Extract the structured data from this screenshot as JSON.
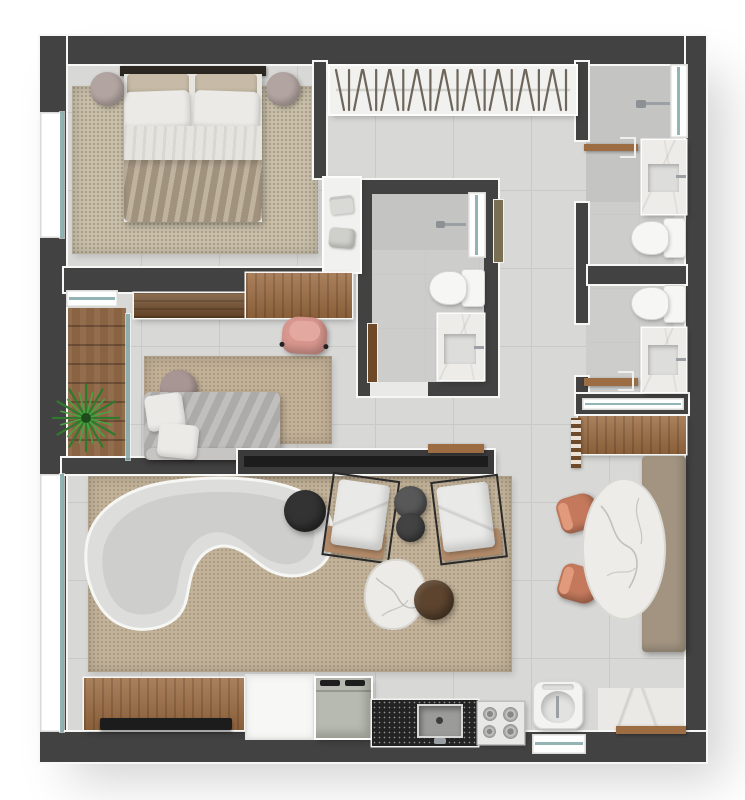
{
  "canvas": {
    "width": 745,
    "height": 800
  },
  "scene": {
    "type": "apartment-floor-plan-top-view",
    "rooms": [
      {
        "name": "bedroom"
      },
      {
        "name": "wardrobe-hall"
      },
      {
        "name": "ensuite-bathroom"
      },
      {
        "name": "bathroom-top-right"
      },
      {
        "name": "bathroom-mid-right"
      },
      {
        "name": "home-office"
      },
      {
        "name": "balcony"
      },
      {
        "name": "living-room"
      },
      {
        "name": "dining-area"
      },
      {
        "name": "kitchen"
      },
      {
        "name": "service-area"
      }
    ],
    "furniture": [
      "double-bed",
      "nightstand",
      "area-rug",
      "wardrobe-hangers",
      "towel-shelf",
      "shower",
      "vanity-sink",
      "toilet",
      "desk",
      "office-chair",
      "daybed",
      "potted-plant",
      "curved-sofa",
      "armchair",
      "pouf",
      "coffee-table",
      "dining-table",
      "dining-chair",
      "bench",
      "sideboard-tv",
      "refrigerator",
      "kitchen-sink",
      "cooktop",
      "laundry-tub",
      "console"
    ]
  },
  "closet": {
    "hanger_count": 26
  },
  "palette": {
    "bg": "#ffffff",
    "wall": "#424242",
    "wall-dark": "#2c2c2c",
    "wall-edge": "#f7f7f6",
    "floor": "#d8d8d7",
    "grout": "#c9c9c8",
    "floor-bath": "#cdcdcc",
    "floor-shower": "#c3c3c2",
    "rug-bedroom": "#c8bfab",
    "rug-office": "#c2b097",
    "rug-living": "#c2b299",
    "rug-dot": "#a4967c",
    "wood": "#9c6c42",
    "wood-dark": "#6f4a28",
    "wood-balcony": "#8a6342",
    "closet": "#f1f1ef",
    "hanger": "#6e665a",
    "marble": "#eeece8",
    "marble-vein": "#b5b5b2",
    "porcelain": "#f6f6f4",
    "basin": "#dddddb",
    "chrome": "#9aa0a3",
    "glass": "#7fa8a8",
    "window": "#ffffff",
    "sofa": "#dddddb",
    "sofa-seat": "#cbcbc9",
    "daybed": "#b9b8b6",
    "pillow-white": "#ebeae6",
    "pillow-beige": "#c7bba7",
    "duvet": "#b3a38c",
    "sheet": "#e6e4df",
    "headboard": "#2e2822",
    "nightstand": "#b2a4a0",
    "chair-pink": "#d8978e",
    "chair-terracotta": "#c4795c",
    "bench": "#a29480",
    "stool-dark": "#4c4c4c",
    "table-dark": "#333333",
    "table-brown": "#5c442e",
    "granite": "#232323",
    "fridge": "#b6bab0",
    "plant": "#3e8a38",
    "tv": "#1c1c1c",
    "door-olive": "#7a6f52"
  }
}
